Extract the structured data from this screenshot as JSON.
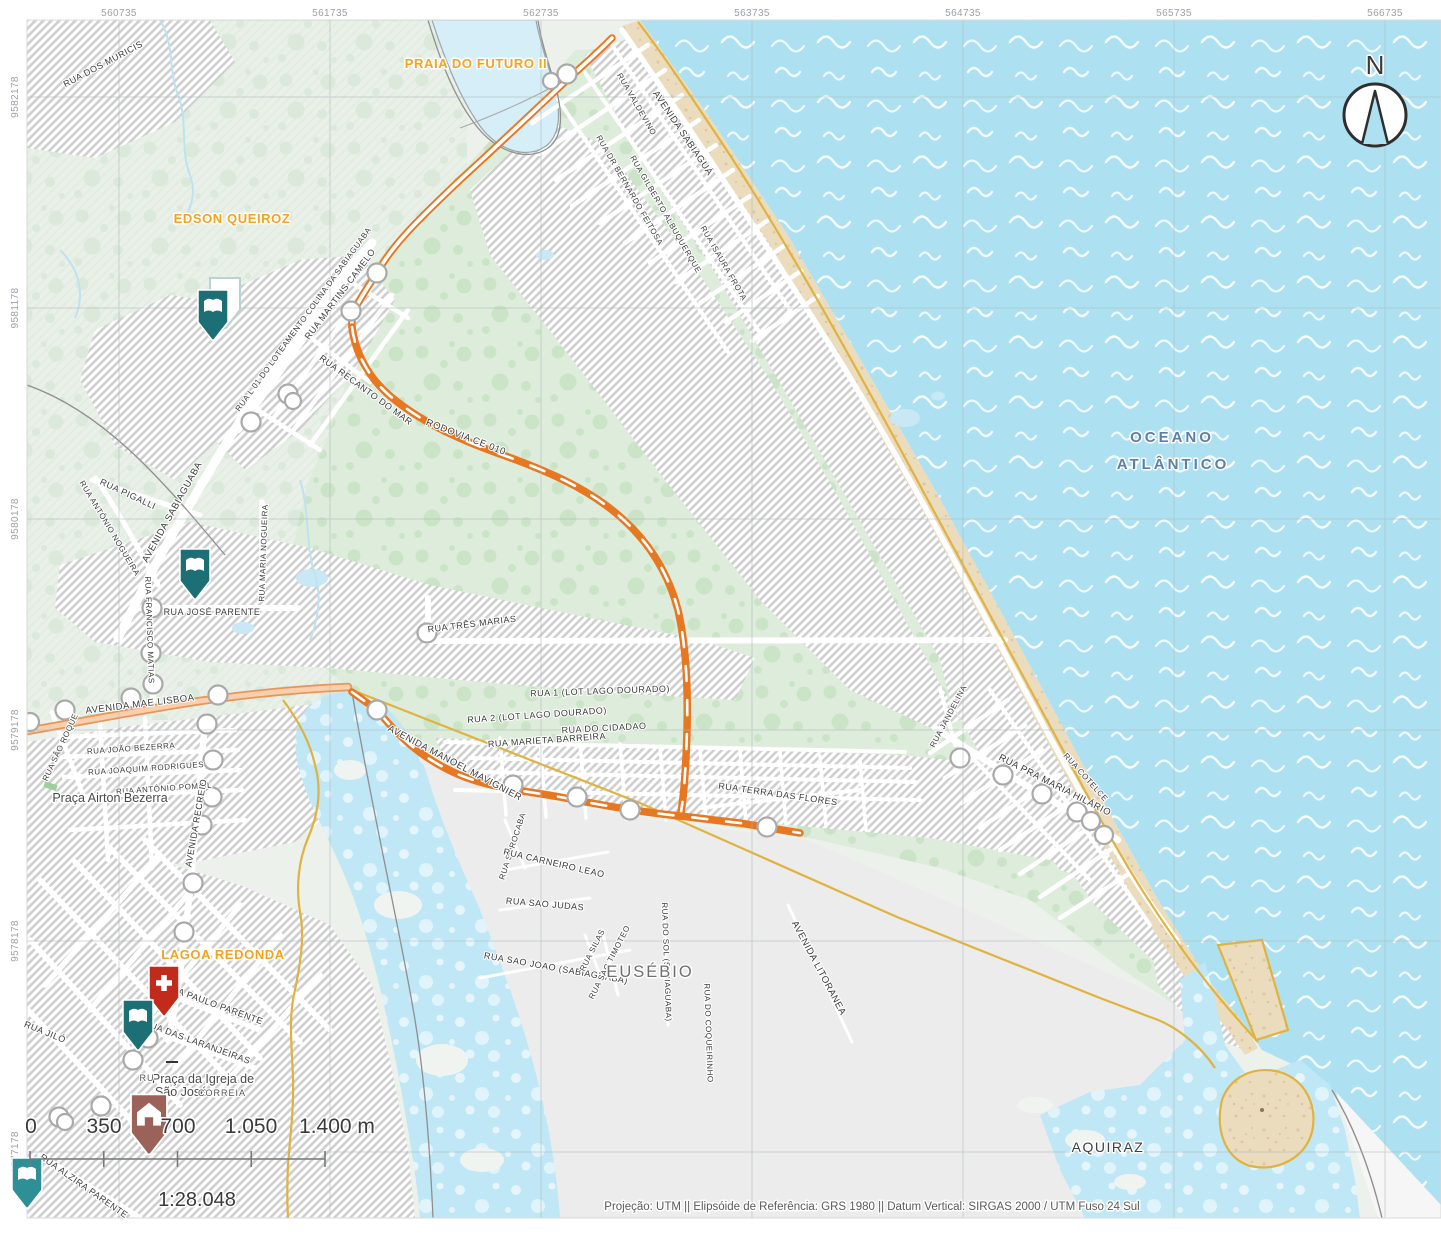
{
  "axis": {
    "top": [
      "560735",
      "561735",
      "562735",
      "563735",
      "564735",
      "565735",
      "566735"
    ],
    "left": [
      "9582178",
      "9581178",
      "9580178",
      "9579178",
      "9578178",
      "9577178"
    ]
  },
  "places": {
    "praia_do_futuro": "PRAIA DO FUTURO II",
    "edson_queiroz": "EDSON QUEIROZ",
    "lagoa_redonda": "LAGOA REDONDA",
    "eusebio": "EUSÉBIO",
    "aquiraz": "AQUIRAZ",
    "oceano_l1": "OCEANO",
    "oceano_l2": "ATLÂNTICO",
    "praca_airton": "Praça Airton Bezerra",
    "praca_igreja_l1": "Praça da Igreja de",
    "praca_igreja_l2": "São José",
    "correia_fragment": "CORREIA",
    "ru_fragment": "RU"
  },
  "streets": [
    "RUA  DOS  MURICIS",
    "AVENIDA  SABIAGUÁ",
    "RUA  VALDEVINO",
    "RUA DR BERNARDO FEITOSA",
    "RUA  GILBERTO ALBUQUERQUE",
    "RUA  ISAURA FROTA",
    "RUA  L 01 DO LOTEAMENTO COLINA DA SABIAGUABA",
    "RUA  MARTINS  CAMELO",
    "RUA  RECANTO DO MAR",
    "RODOVIA   CE 010",
    "RUA  PIGALLI",
    "AVENIDA  SABIAGUABA",
    "RUA  ANTÔNIO NOGUEIRA",
    "RUA  MARIA  NOGUEIRA",
    "RUA  FRANCISCO MATIAS",
    "RUA   JOSÉ  PARENTE",
    "RUA   TRÊS  MARIAS",
    "AVENIDA  MAE  LISBOA",
    "RUA SÃO ROQUE",
    "RUA   JOÃO  BEZERRA",
    "RUA   JOAQUIM  RODRIGUES",
    "RUA   ANTÔNIO  POMPIL",
    "AVENIDA   RECREIO",
    "RUA   1 (LOT LAGO DOURADO)",
    "RUA   2  (LOT LAGO DOURADO)",
    "RUA   DO  CIDADAO",
    "RUA   MARIETA  BARREIRA",
    "AVENIDA   MANOEL  MAVIGNIER",
    "RUA  SOROCABA",
    "RUA   CARNEIRO  LEAO",
    "RUA  SAO  JUDAS",
    "RUA  SAO  JOAO  (SABIAGUABA)",
    "RUA   SILAS",
    "RUA  SAO  TIMOTEO",
    "RUA   DO  SOL  (SABIAGUABA)",
    "RUA   DO  COQUEIRINHO",
    "AVENIDA   LITORANEA",
    "RUA   TERRA  DAS  FLORES",
    "RUA   JANDELINA",
    "RUA  PRA  MARIA  HILÁRIO",
    "RUA   COTELCE",
    "RUA   PAULO  PARENTE",
    "RUA   DAS  LARANJEIRAS",
    "RUA   JILÓ",
    "RUA   ALZIRA  PARENTE"
  ],
  "north_label": "N",
  "scalebar": {
    "ticks": [
      "0",
      "350",
      "700",
      "1.050",
      "1.400 m"
    ],
    "ratio": "1:28.048"
  },
  "footer": "Projeção: UTM || Elipsóide de Referência:  GRS 1980 || Datum Vertical: SIRGAS 2000 / UTM Fuso 24 Sul",
  "markers": [
    {
      "name": "library-marker-north",
      "icon": "open-book",
      "color": "#1B6F75"
    },
    {
      "name": "library-marker-center",
      "icon": "open-book",
      "color": "#1B6F75"
    },
    {
      "name": "hospital-marker",
      "icon": "cross",
      "color": "#C02B1C"
    },
    {
      "name": "library-marker-lagoa",
      "icon": "open-book",
      "color": "#1B6F75"
    },
    {
      "name": "church-marker",
      "icon": "house",
      "color": "#9A6258"
    },
    {
      "name": "library-marker-edge",
      "icon": "open-book",
      "color": "#2E8F96"
    }
  ],
  "colors": {
    "ocean": "#ADE1F2",
    "lagoon": "#BFE7F6",
    "vegetation": "#DEEDDB",
    "vegetation_dots": "#C8E3C5",
    "urban_hatch": "#CFCFCF",
    "south_land": "#ECECEC",
    "sand": "#EBDCBE",
    "route_orange": "#E87722",
    "road_peach": "#F8CFAC",
    "boundary_yellow": "#E0B23E",
    "label_orange": "#F5A31F",
    "ocean_label": "#5C7FA8",
    "marker_teal": "#1B6F75",
    "marker_red": "#C02B1C",
    "marker_brown": "#9A6258"
  }
}
